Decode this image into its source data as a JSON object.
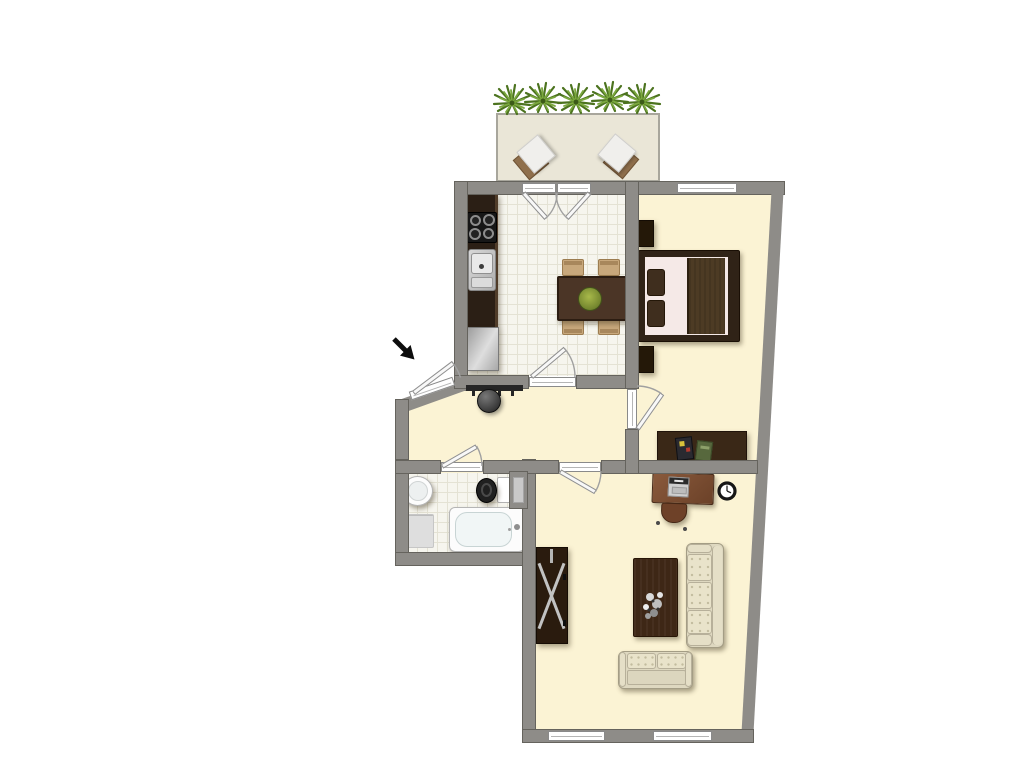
{
  "document": {
    "type": "apartment floor plan, top-down 2D view",
    "visible_text": "none"
  },
  "palette": {
    "background": "#ffffff",
    "wall": "#8e8c88",
    "wall_edge": "#65635d",
    "floor_cream": "#fbf3d4",
    "tile_floor": "#f6f5ee",
    "tile_line": "#e4e2d4",
    "balcony_floor": "#eae6d7",
    "balcony_edge": "#a8a69c",
    "window_fill": "#ffffff",
    "window_edge": "#8a8a8a",
    "door_leaf": "#f8f8f8",
    "arc": "#a0a0a0",
    "dark_wood": "#33241a",
    "table_wood": "#4b3526",
    "desk_wood": "#7a4e33",
    "chair_tan": "#c8a87c",
    "sofa_cream": "#ded8c0",
    "sofa_cushion": "#e9e3ca",
    "sofa_edge": "#a49d85",
    "bed_sheet": "#f5e9e7",
    "bed_blanket": "#4d3b24",
    "metal": "#c9c9c9",
    "plant_dark": "#4c731f",
    "plant_light": "#7ba83e",
    "arrow": "#0d0d0d"
  },
  "balcony": {
    "plants": 5,
    "stools": 2
  },
  "rooms": [
    {
      "id": "kitchen",
      "floor": "white tile",
      "furniture": [
        "kitchen counter",
        "stove with 4 burners",
        "kitchen sink",
        "refrigerator",
        "dining table",
        "4 dining chairs",
        "table plant"
      ]
    },
    {
      "id": "bedroom",
      "floor": "cream",
      "furniture": [
        "double bed",
        "2 pillows",
        "2 nightstands",
        "sideboard",
        "2 books"
      ]
    },
    {
      "id": "hallway",
      "floor": "cream",
      "furniture": [
        "coat rack"
      ]
    },
    {
      "id": "bathroom",
      "floor": "white tile",
      "furniture": [
        "washbasin",
        "bath mat",
        "toilet",
        "bathtub"
      ]
    },
    {
      "id": "living-room",
      "floor": "cream",
      "furniture": [
        "desk",
        "laptop",
        "desk chair",
        "wall clock",
        "wardrobe",
        "coffee table",
        "three-seat sofa",
        "two-seat sofa"
      ]
    }
  ],
  "openings": {
    "doors": [
      "entry door (angled wall)",
      "balcony double door",
      "kitchen door",
      "bedroom door",
      "bathroom door",
      "living room door"
    ],
    "windows": [
      "bedroom window",
      "living room window left",
      "living room window right"
    ]
  },
  "annotations": {
    "entry_arrow": "black arrow pointing to the entrance door"
  }
}
